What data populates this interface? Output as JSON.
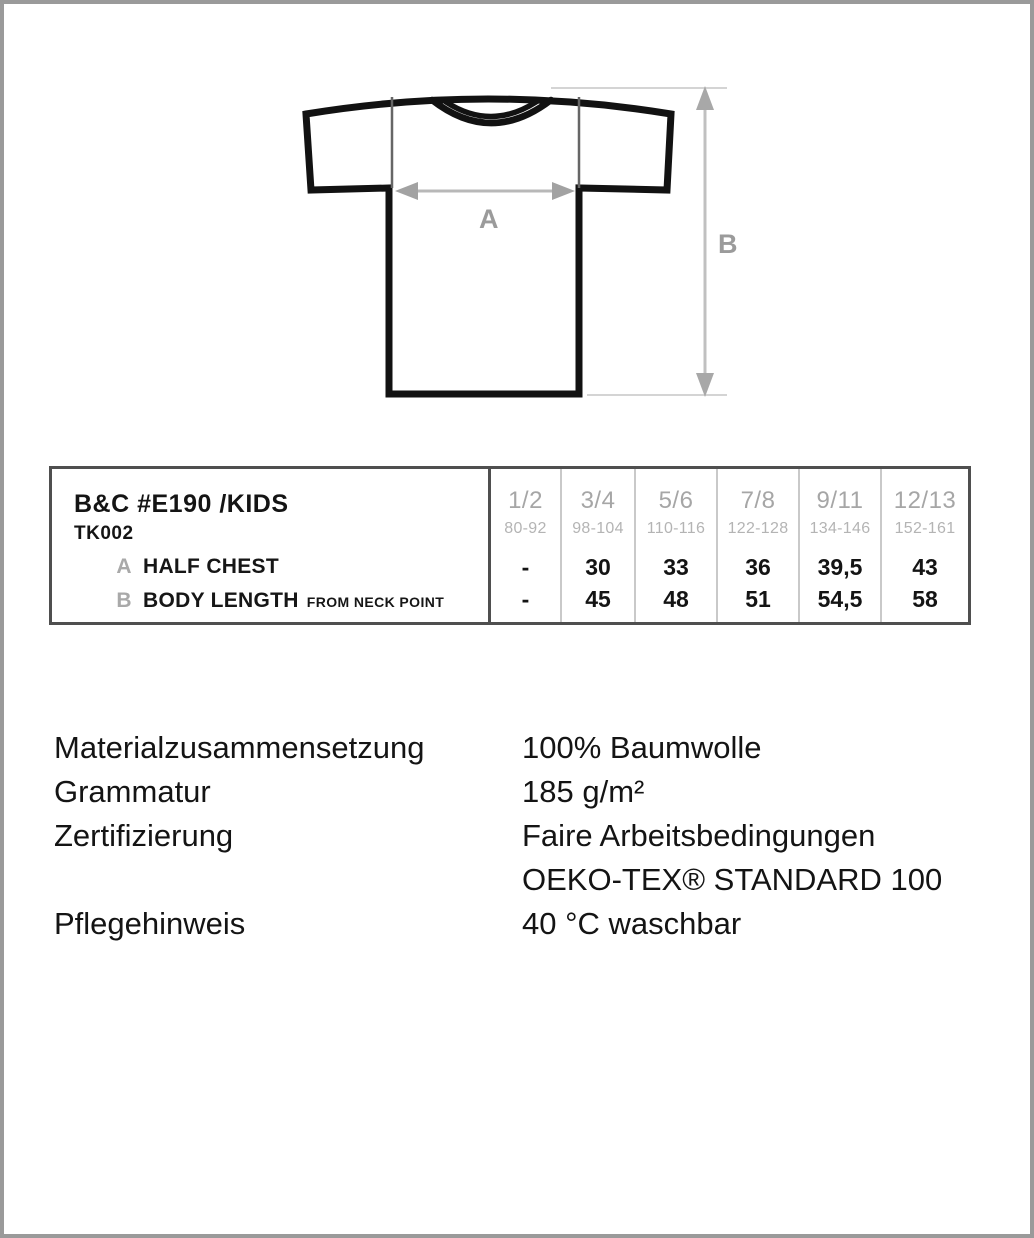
{
  "diagram": {
    "labels": {
      "width_arrow": "A",
      "length_arrow": "B"
    },
    "colors": {
      "outline": "#121212",
      "arrow_line": "#b8b8b8",
      "arrow_head": "#a2a2a2",
      "measure_label": "#9b9b9b",
      "chest_guide": "#666666",
      "extension_guide": "#d4d4d4"
    }
  },
  "table": {
    "title": "B&C #E190 /KIDS",
    "subtitle": "TK002",
    "rows": [
      {
        "key": "A",
        "label": "HALF CHEST",
        "suffix": ""
      },
      {
        "key": "B",
        "label": "BODY LENGTH",
        "suffix": "FROM NECK POINT"
      }
    ],
    "columns": [
      {
        "size": "1/2",
        "age": "80-92",
        "half_chest": "-",
        "body_length": "-"
      },
      {
        "size": "3/4",
        "age": "98-104",
        "half_chest": "30",
        "body_length": "45"
      },
      {
        "size": "5/6",
        "age": "110-116",
        "half_chest": "33",
        "body_length": "48"
      },
      {
        "size": "7/8",
        "age": "122-128",
        "half_chest": "36",
        "body_length": "51"
      },
      {
        "size": "9/11",
        "age": "134-146",
        "half_chest": "39,5",
        "body_length": "54,5"
      },
      {
        "size": "12/13",
        "age": "152-161",
        "half_chest": "43",
        "body_length": "58"
      }
    ]
  },
  "info": {
    "rows": [
      {
        "label": "Materialzusammensetzung",
        "value": "100% Baumwolle"
      },
      {
        "label": "Grammatur",
        "value": "185 g/m²"
      },
      {
        "label": "Zertifizierung",
        "value": "Faire Arbeitsbedingungen"
      },
      {
        "label": "",
        "value": "OEKO-TEX® STANDARD 100"
      },
      {
        "label": "Pflegehinweis",
        "value": "40 °C waschbar"
      }
    ]
  }
}
